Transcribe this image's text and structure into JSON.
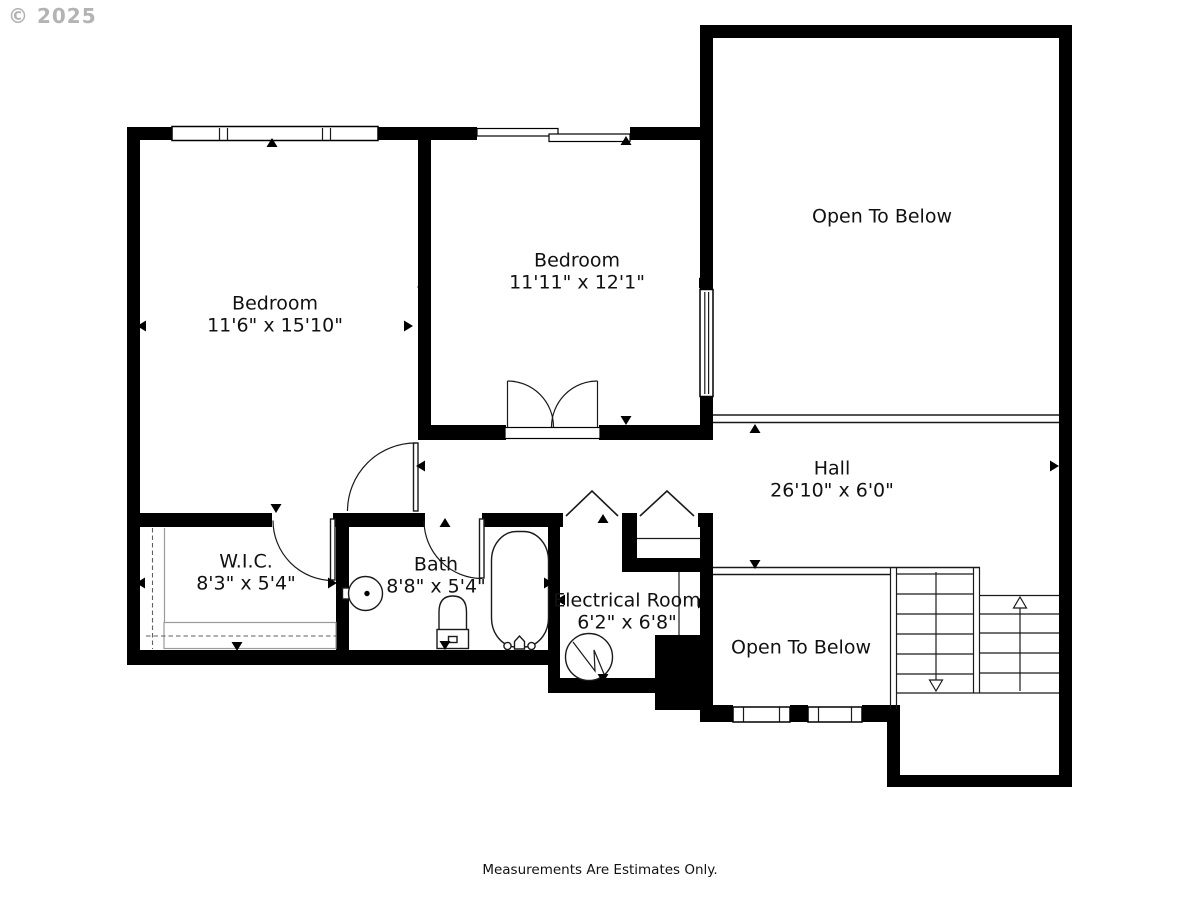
{
  "watermark": "© 2025",
  "footer": "Measurements Are Estimates Only.",
  "rooms": [
    {
      "name": "Bedroom",
      "dims": "11'6\" x 15'10\""
    },
    {
      "name": "Bedroom",
      "dims": "11'11\" x 12'1\""
    },
    {
      "name": "Open To Below",
      "dims": ""
    },
    {
      "name": "Hall",
      "dims": "26'10\" x 6'0\""
    },
    {
      "name": "W.I.C.",
      "dims": "8'3\" x 5'4\""
    },
    {
      "name": "Bath",
      "dims": "8'8\" x 5'4\""
    },
    {
      "name": "Electrical Room",
      "dims": "6'2\" x 6'8\""
    },
    {
      "name": "Open To Below",
      "dims": ""
    }
  ],
  "colors": {
    "wall": "#000000",
    "line": "#1a1a1a",
    "closet": "#9a9a9a",
    "wm": "#b3b3b3"
  }
}
